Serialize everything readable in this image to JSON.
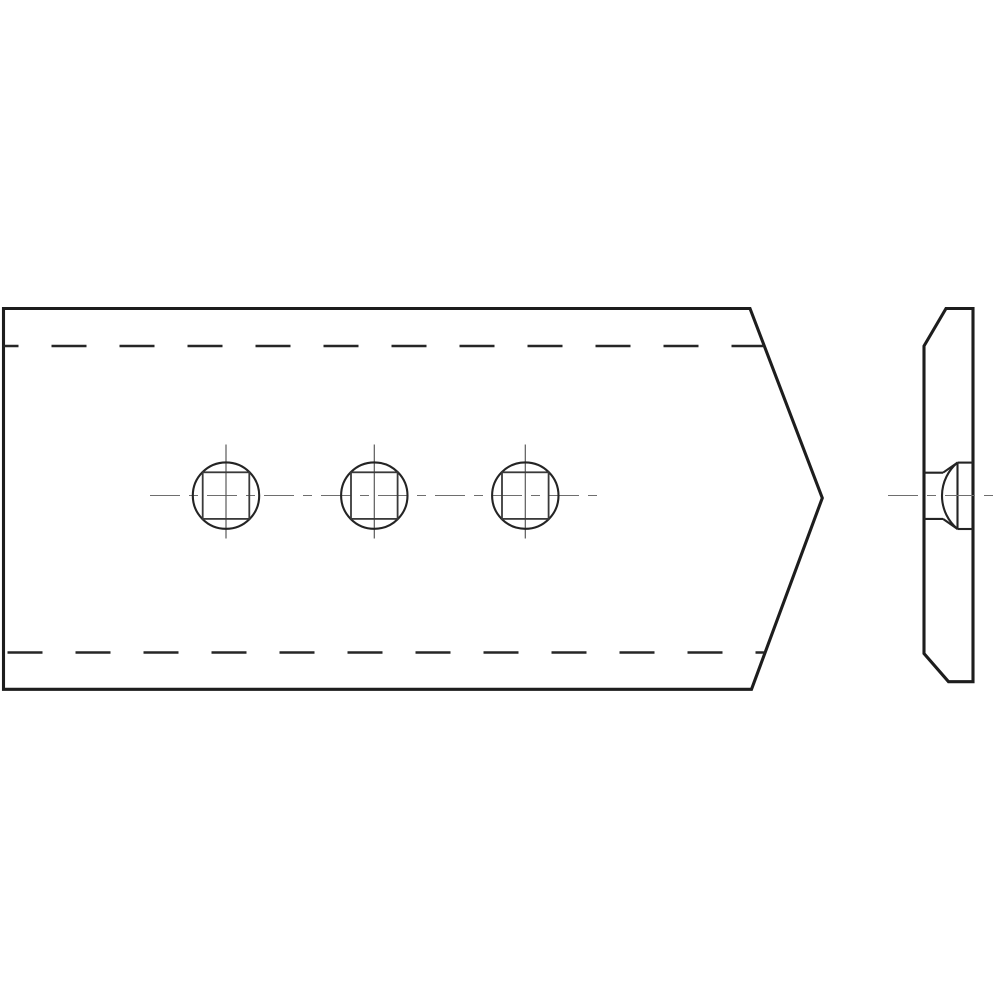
{
  "canvas": {
    "width": 1000,
    "height": 1000,
    "background": "#ffffff"
  },
  "styles": {
    "outline_color": "#1d1d1d",
    "outline_width": 3.1,
    "detail_color": "#242424",
    "detail_width": 2.1,
    "square_color": "#3a3a3a",
    "square_width": 1.8,
    "hidden_color": "#262626",
    "hidden_width": 2.4,
    "hidden_dash": "35 33",
    "center_color": "#6e6e6e",
    "center_width": 1.1,
    "center_dash": "30 9 9 9",
    "vertical_center_color": "#5a5a5a",
    "vertical_center_width": 1.2,
    "fill": "#ffffff"
  },
  "front_view": {
    "outline_points": "3.5,308.5 750,308.5 822.3,498 751.5,689.3 3.5,689.3",
    "hidden_top": {
      "y": 346,
      "x1": 3.5,
      "x2": 764,
      "offset": 20
    },
    "hidden_bottom": {
      "y": 652.5,
      "x1": 3.5,
      "x2": 765.3,
      "offset": 64
    },
    "holes": {
      "centers_x": [
        226,
        374.3,
        525.3
      ],
      "center_y": 495.6,
      "circle_radius": 33.2,
      "square_half": 23.3,
      "vline_y1": 444.5,
      "vline_y2": 538.5
    },
    "centerline": {
      "y": 495.5,
      "x1": 150,
      "x2": 603
    }
  },
  "side_view": {
    "outline_points": "946,308.5 973,308.5 973,681.7 948.5,681.7 924,653.5 924,346",
    "bolt": {
      "face_x": 924,
      "bore_x2": 943,
      "bore_y_top": 472.7,
      "bore_y_bottom": 518.9,
      "chord_x": 957.5,
      "head_y_top": 462.6,
      "head_y_bottom": 529,
      "back_x": 973,
      "dome_radius": 43.3
    },
    "centerline": {
      "y": 495.5,
      "x1": 888,
      "x2": 1000
    }
  }
}
